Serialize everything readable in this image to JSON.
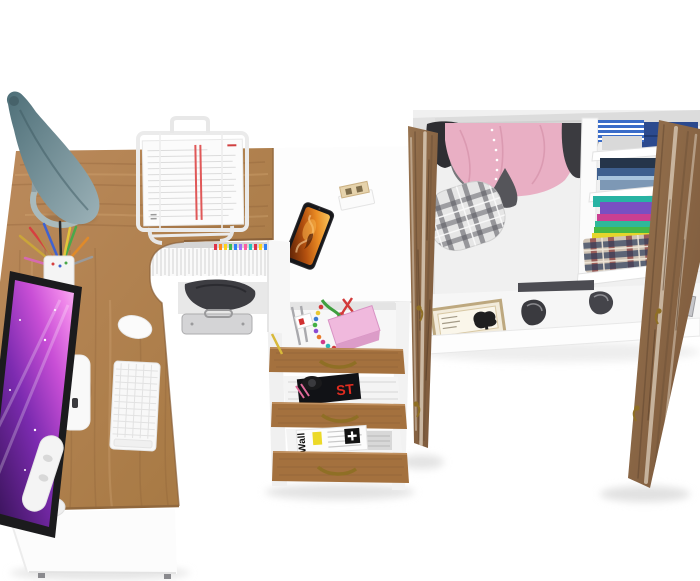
{
  "scene": {
    "type": "3d-furniture-render-top-view",
    "background": "#ffffff",
    "description": "Bird's-eye 3D render of a white and oak kids furniture set: corner computer desk, open three-drawer pedestal and a wardrobe with open doors"
  },
  "palette": {
    "desk_wood": "#b2824f",
    "wood_grain": "#7e5531",
    "drawer_wood": "#a4713e",
    "door_wood": "#8d6747",
    "white_surface": "#fdfdfd",
    "lamp_body": "#5d7e87",
    "monitor_screen": "#a13fc4",
    "phone_screen": "#e07820",
    "brass_handle": "#8f6f25",
    "pink_garment": "#e9afc4"
  },
  "desk": {
    "surface_items": [
      "desk-lamp",
      "pen-cup",
      "document-stand",
      "monitor",
      "keyboard",
      "mouse"
    ],
    "under_shelf_items": [
      "binders",
      "backpack",
      "metal-case"
    ],
    "white_top_items": [
      "smartphone",
      "wood-block-calendar"
    ]
  },
  "drawer_unit": {
    "open_drawers": 3,
    "top_drawer_items": [
      "pink-box",
      "bead-chain",
      "scissors",
      "green-cord",
      "pens"
    ],
    "middle_magazine_text": "ST",
    "bottom_magazine_title": "Wall"
  },
  "wardrobe": {
    "left_section": [
      "hanging-clothes",
      "plaid-basket"
    ],
    "shelf_stack": [
      "blue-shirts",
      "denim-stack",
      "colorful-tees",
      "plaid-blanket"
    ],
    "floor_items": [
      "picture-frame",
      "shoes"
    ],
    "doors_open": 2
  }
}
